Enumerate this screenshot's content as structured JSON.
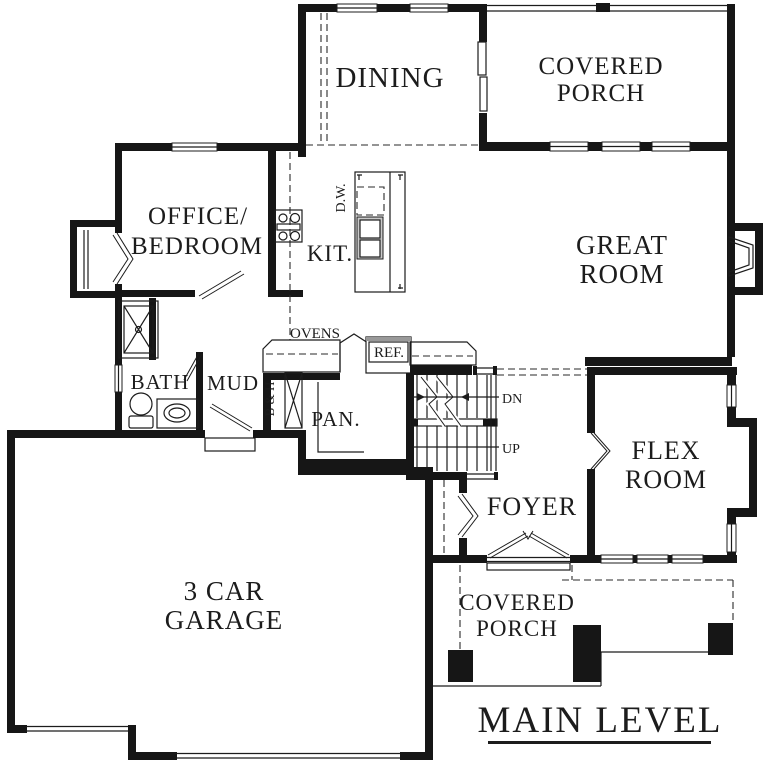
{
  "page_title": "MAIN LEVEL floor plan",
  "colors": {
    "background": "#ffffff",
    "line": "#161616",
    "text": "#1c1c1c",
    "appliance_shade": "#c9c9c9"
  },
  "labels": {
    "dining": "DINING",
    "covered_porch_upper": [
      "COVERED",
      "PORCH"
    ],
    "office_bedroom": [
      "OFFICE/",
      "BEDROOM"
    ],
    "kitchen": "KIT.",
    "dishwasher": "D.W.",
    "ovens": "OVENS",
    "refrigerator": "REF.",
    "great_room": [
      "GREAT",
      "ROOM"
    ],
    "bath": "BATH",
    "mud": "MUD",
    "broom_hamper": "B & H",
    "pantry": "PAN.",
    "down": "DN",
    "up": "UP",
    "flex_room": [
      "FLEX",
      "ROOM"
    ],
    "foyer": "FOYER",
    "garage": [
      "3 CAR",
      "GARAGE"
    ],
    "covered_porch_lower": [
      "COVERED",
      "PORCH"
    ],
    "plan_title": "MAIN LEVEL"
  }
}
